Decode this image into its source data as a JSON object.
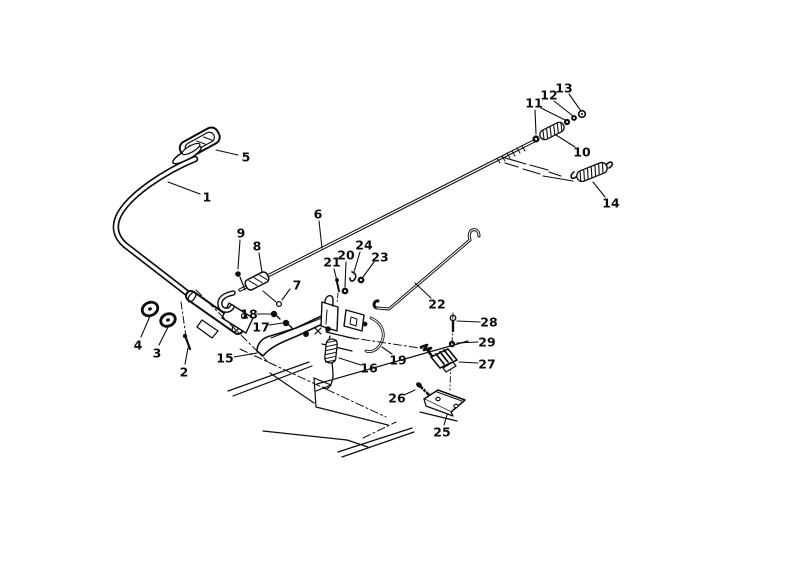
{
  "diagram": {
    "background_color": "#ffffff",
    "ink_color": "#0d0d0d",
    "callout_font_size": 12.5,
    "callouts": [
      {
        "n": "1",
        "x": 207,
        "y": 197,
        "leaders": [
          [
            200,
            194,
            168,
            182
          ]
        ]
      },
      {
        "n": "2",
        "x": 184,
        "y": 372,
        "leaders": [
          [
            185,
            364,
            188,
            348
          ]
        ]
      },
      {
        "n": "3",
        "x": 157,
        "y": 353,
        "leaders": [
          [
            159,
            345,
            168,
            327
          ]
        ]
      },
      {
        "n": "4",
        "x": 138,
        "y": 345,
        "leaders": [
          [
            141,
            337,
            150,
            316
          ]
        ]
      },
      {
        "n": "5",
        "x": 246,
        "y": 157,
        "leaders": [
          [
            238,
            155,
            216,
            150
          ]
        ]
      },
      {
        "n": "6",
        "x": 318,
        "y": 214,
        "leaders": [
          [
            319,
            221,
            322,
            248
          ]
        ]
      },
      {
        "n": "7",
        "x": 297,
        "y": 285,
        "leaders": [
          [
            290,
            289,
            282,
            300
          ]
        ]
      },
      {
        "n": "8",
        "x": 257,
        "y": 246,
        "leaders": [
          [
            259,
            253,
            262,
            272
          ]
        ]
      },
      {
        "n": "9",
        "x": 241,
        "y": 233,
        "leaders": [
          [
            240,
            240,
            238,
            269
          ]
        ]
      },
      {
        "n": "10",
        "x": 582,
        "y": 152,
        "leaders": [
          [
            575,
            147,
            556,
            135
          ]
        ]
      },
      {
        "n": "11",
        "x": 534,
        "y": 103,
        "leaders": [
          [
            535,
            110,
            536,
            134
          ],
          [
            541,
            108,
            565,
            120
          ]
        ]
      },
      {
        "n": "12",
        "x": 549,
        "y": 95,
        "leaders": [
          [
            554,
            101,
            573,
            116
          ]
        ]
      },
      {
        "n": "13",
        "x": 564,
        "y": 88,
        "leaders": [
          [
            569,
            94,
            581,
            111
          ]
        ]
      },
      {
        "n": "14",
        "x": 611,
        "y": 203,
        "leaders": [
          [
            605,
            197,
            593,
            182
          ]
        ]
      },
      {
        "n": "15",
        "x": 225,
        "y": 358,
        "leaders": [
          [
            234,
            357,
            257,
            353
          ]
        ]
      },
      {
        "n": "16",
        "x": 369,
        "y": 368,
        "leaders": [
          [
            361,
            365,
            339,
            358
          ]
        ]
      },
      {
        "n": "17",
        "x": 261,
        "y": 327,
        "leaders": [
          [
            269,
            325,
            283,
            323
          ]
        ]
      },
      {
        "n": "18",
        "x": 249,
        "y": 314,
        "leaders": [
          [
            257,
            314,
            271,
            314
          ]
        ]
      },
      {
        "n": "19",
        "x": 398,
        "y": 360,
        "leaders": [
          [
            392,
            354,
            382,
            347
          ]
        ]
      },
      {
        "n": "20",
        "x": 346,
        "y": 255,
        "leaders": [
          [
            346,
            262,
            345,
            287
          ]
        ]
      },
      {
        "n": "21",
        "x": 332,
        "y": 262,
        "leaders": [
          [
            334,
            269,
            337,
            281
          ]
        ]
      },
      {
        "n": "22",
        "x": 437,
        "y": 304,
        "leaders": [
          [
            431,
            298,
            415,
            283
          ]
        ]
      },
      {
        "n": "23",
        "x": 380,
        "y": 257,
        "leaders": [
          [
            374,
            262,
            363,
            277
          ]
        ]
      },
      {
        "n": "24",
        "x": 364,
        "y": 245,
        "leaders": [
          [
            360,
            252,
            354,
            272
          ]
        ]
      },
      {
        "n": "25",
        "x": 442,
        "y": 432,
        "leaders": [
          [
            444,
            425,
            447,
            415
          ]
        ]
      },
      {
        "n": "26",
        "x": 397,
        "y": 398,
        "leaders": [
          [
            404,
            395,
            415,
            390
          ]
        ]
      },
      {
        "n": "27",
        "x": 487,
        "y": 364,
        "leaders": [
          [
            478,
            363,
            459,
            362
          ]
        ]
      },
      {
        "n": "28",
        "x": 489,
        "y": 322,
        "leaders": [
          [
            480,
            322,
            457,
            321
          ]
        ]
      },
      {
        "n": "29",
        "x": 487,
        "y": 342,
        "leaders": [
          [
            478,
            342,
            457,
            343
          ]
        ]
      }
    ]
  }
}
